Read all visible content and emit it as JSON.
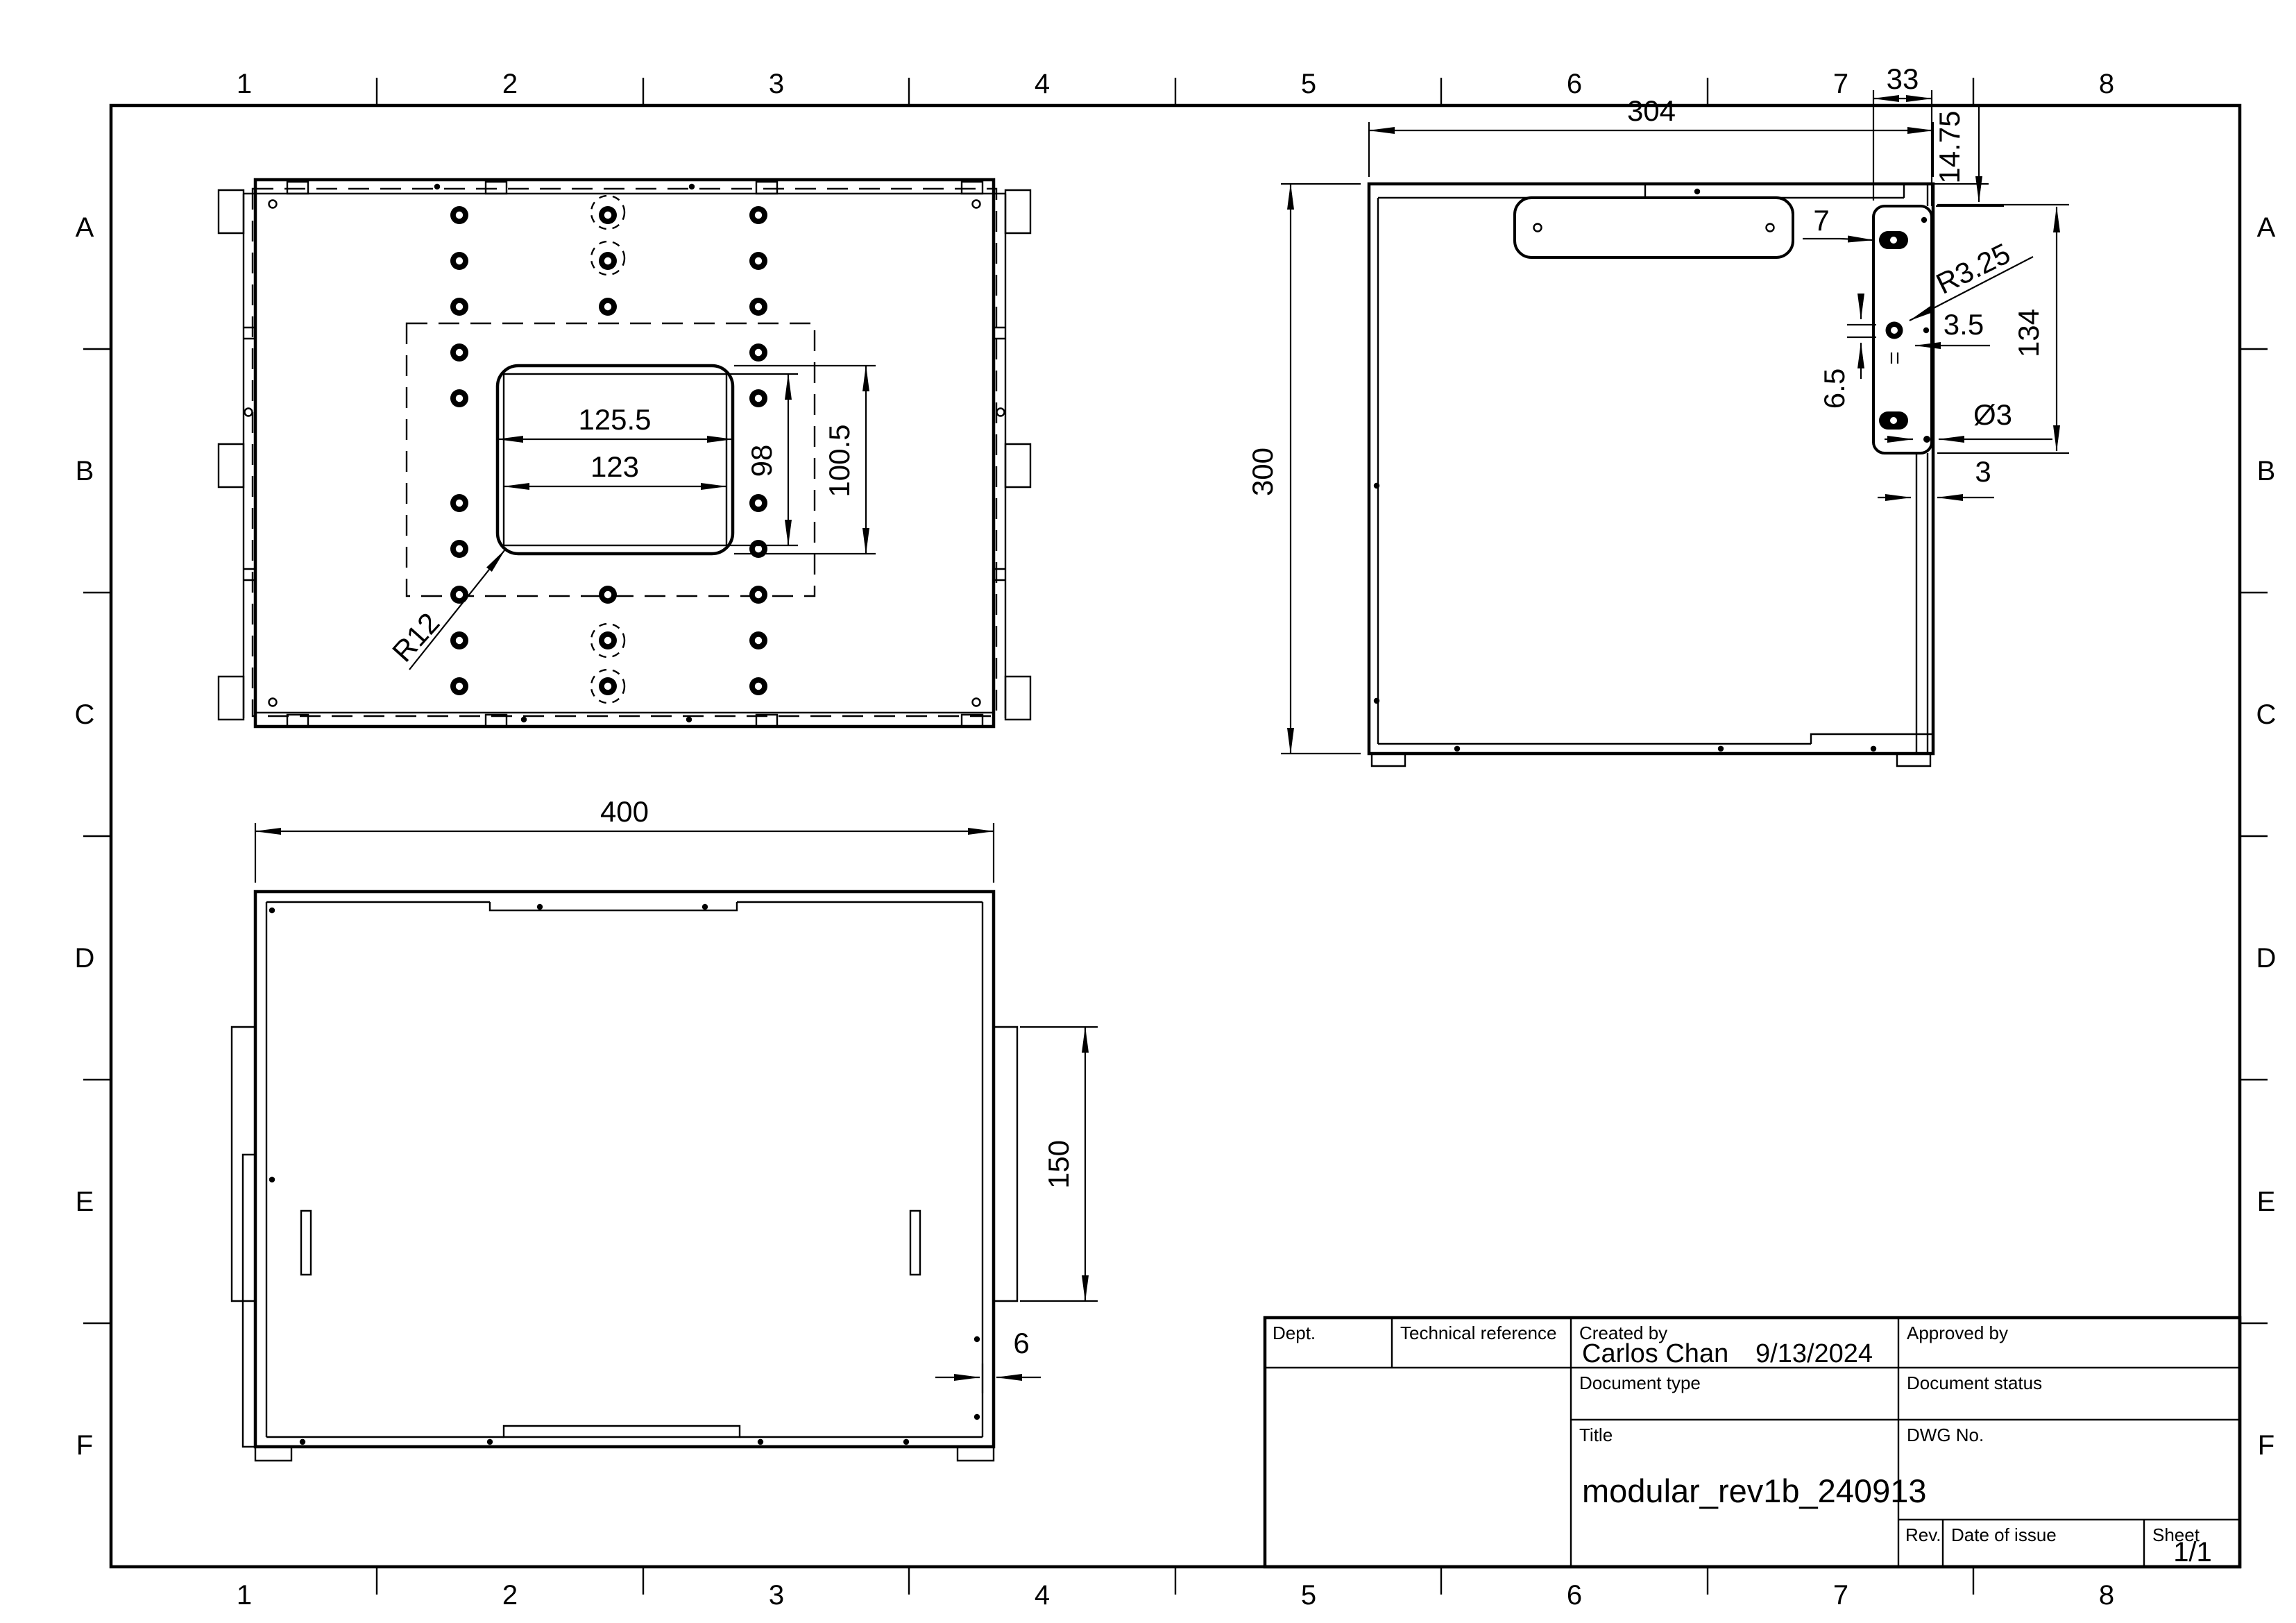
{
  "border": {
    "cols": [
      "1",
      "2",
      "3",
      "4",
      "5",
      "6",
      "7",
      "8"
    ],
    "rows": [
      "A",
      "B",
      "C",
      "D",
      "E",
      "F"
    ]
  },
  "top_view": {
    "dim_width_outer": "125.5",
    "dim_width_inner": "123",
    "dim_height_inner": "98",
    "dim_height_outer": "100.5",
    "dim_corner_radius": "R12"
  },
  "side_view": {
    "dim_width": "304",
    "dim_height": "300",
    "dim_plate_width": "33",
    "dim_plate_top_offset": "14.75",
    "dim_slot_length": "7",
    "dim_slot_radius": "R3.25",
    "dim_hole_offset": "3.5",
    "dim_hole_gap": "6.5",
    "dim_hole_diameter": "Ø3",
    "dim_hole_span": "134",
    "dim_wall_thickness": "3"
  },
  "front_view": {
    "dim_width": "400",
    "dim_side_height": "150",
    "dim_wall_thickness": "6"
  },
  "title_block": {
    "dept_label": "Dept.",
    "technical_reference_label": "Technical reference",
    "created_by_label": "Created by",
    "created_by_value": "Carlos Chan",
    "created_date_value": "9/13/2024",
    "approved_by_label": "Approved by",
    "document_type_label": "Document type",
    "document_status_label": "Document status",
    "title_label": "Title",
    "title_value": "modular_rev1b_240913",
    "dwg_no_label": "DWG No.",
    "rev_label": "Rev.",
    "date_of_issue_label": "Date of issue",
    "sheet_label": "Sheet",
    "sheet_value": "1/1"
  }
}
